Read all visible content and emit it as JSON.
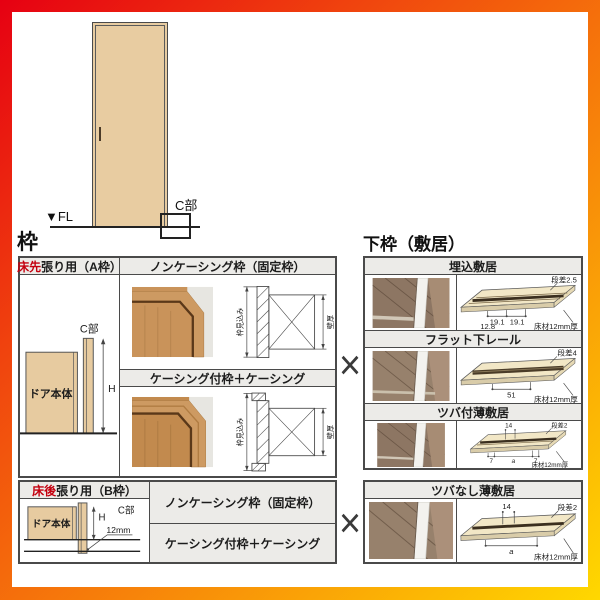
{
  "headings": {
    "frame": "枠",
    "lower_frame": "下枠（敷居）"
  },
  "door_illustration": {
    "c_part": "C部",
    "floor_level": "▼FL"
  },
  "frame_table_a": {
    "type_red": "床先",
    "type_rest": "張り用（A枠）",
    "noncasing_header": "ノンケーシング枠（固定枠）",
    "casing_header": "ケーシング付枠＋ケーシング",
    "door_body": "ドア本体",
    "h_dim": "H",
    "c_part": "C部",
    "jamb_depth": "枠見込み",
    "wall_thickness": "壁厚",
    "jamb_depth2": "枠見込み",
    "wall_thickness2": "壁厚"
  },
  "frame_table_b": {
    "type_red": "床後",
    "type_rest": "張り用（B枠）",
    "door_body": "ドア本体",
    "h_dim": "H",
    "c_part": "C部",
    "floor_offset": "12mm",
    "noncasing_header": "ノンケーシング枠（固定枠）",
    "casing_header": "ケーシング付枠＋ケーシング"
  },
  "sill_table": {
    "rows": [
      {
        "title": "埋込敷居",
        "step": "段差2.5",
        "dim_left": "19.1",
        "dim_right": "19.1",
        "dim_center": "12.8",
        "floor_note": "床材12mm厚"
      },
      {
        "title": "フラット下レール",
        "step": "段差4",
        "dim_center": "51",
        "floor_note": "床材12mm厚"
      },
      {
        "title": "ツバ付薄敷居",
        "step": "段差2",
        "dim_top": "14",
        "dim_left": "7",
        "dim_center": "a",
        "dim_right": "7",
        "floor_note": "床材12mm厚"
      },
      {
        "title": "ツバなし薄敷居",
        "step": "段差2",
        "dim_top": "14",
        "dim_center": "a",
        "floor_note": "床材12mm厚"
      }
    ]
  },
  "separator": {
    "symbol": "×"
  }
}
